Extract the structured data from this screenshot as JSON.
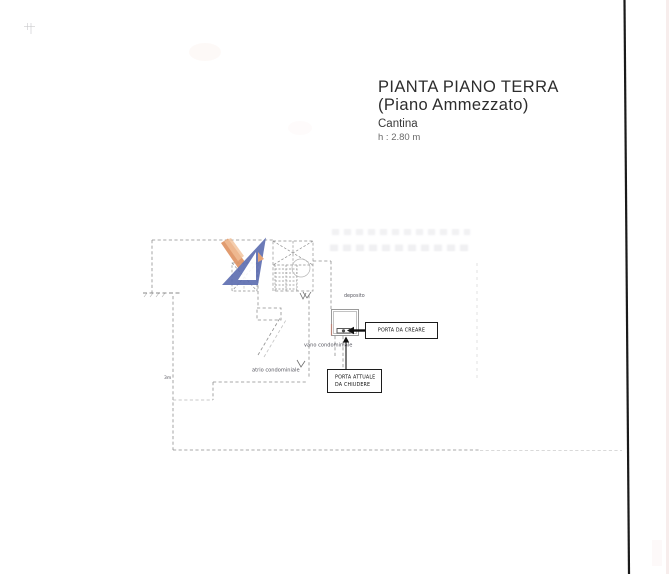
{
  "document": {
    "kind": "scanned floor plan page",
    "background": "#ffffff"
  },
  "title_block": {
    "line1": "PIANTA PIANO TERRA",
    "line2": "(Piano Ammezzato)",
    "line3": "Cantina",
    "height_note": "h : 2.80 m"
  },
  "plan": {
    "room_label": "deposito",
    "vano_label": "vano condominiale",
    "atrio_label": "atrio condominiale",
    "dimension_label": "3m",
    "callouts": {
      "door_to_create": "PORTA DA CREARE",
      "door_to_close_line1": "PORTA ATTUALE",
      "door_to_close_line2": "DA CHIUDERE"
    }
  },
  "colors": {
    "plan_line": "#8f8f8f",
    "dark_line": "#1c1c1c",
    "watermark_blue": "#5b6cb0",
    "watermark_orange": "#de9160",
    "scan_edge": "#1a1a1a"
  }
}
